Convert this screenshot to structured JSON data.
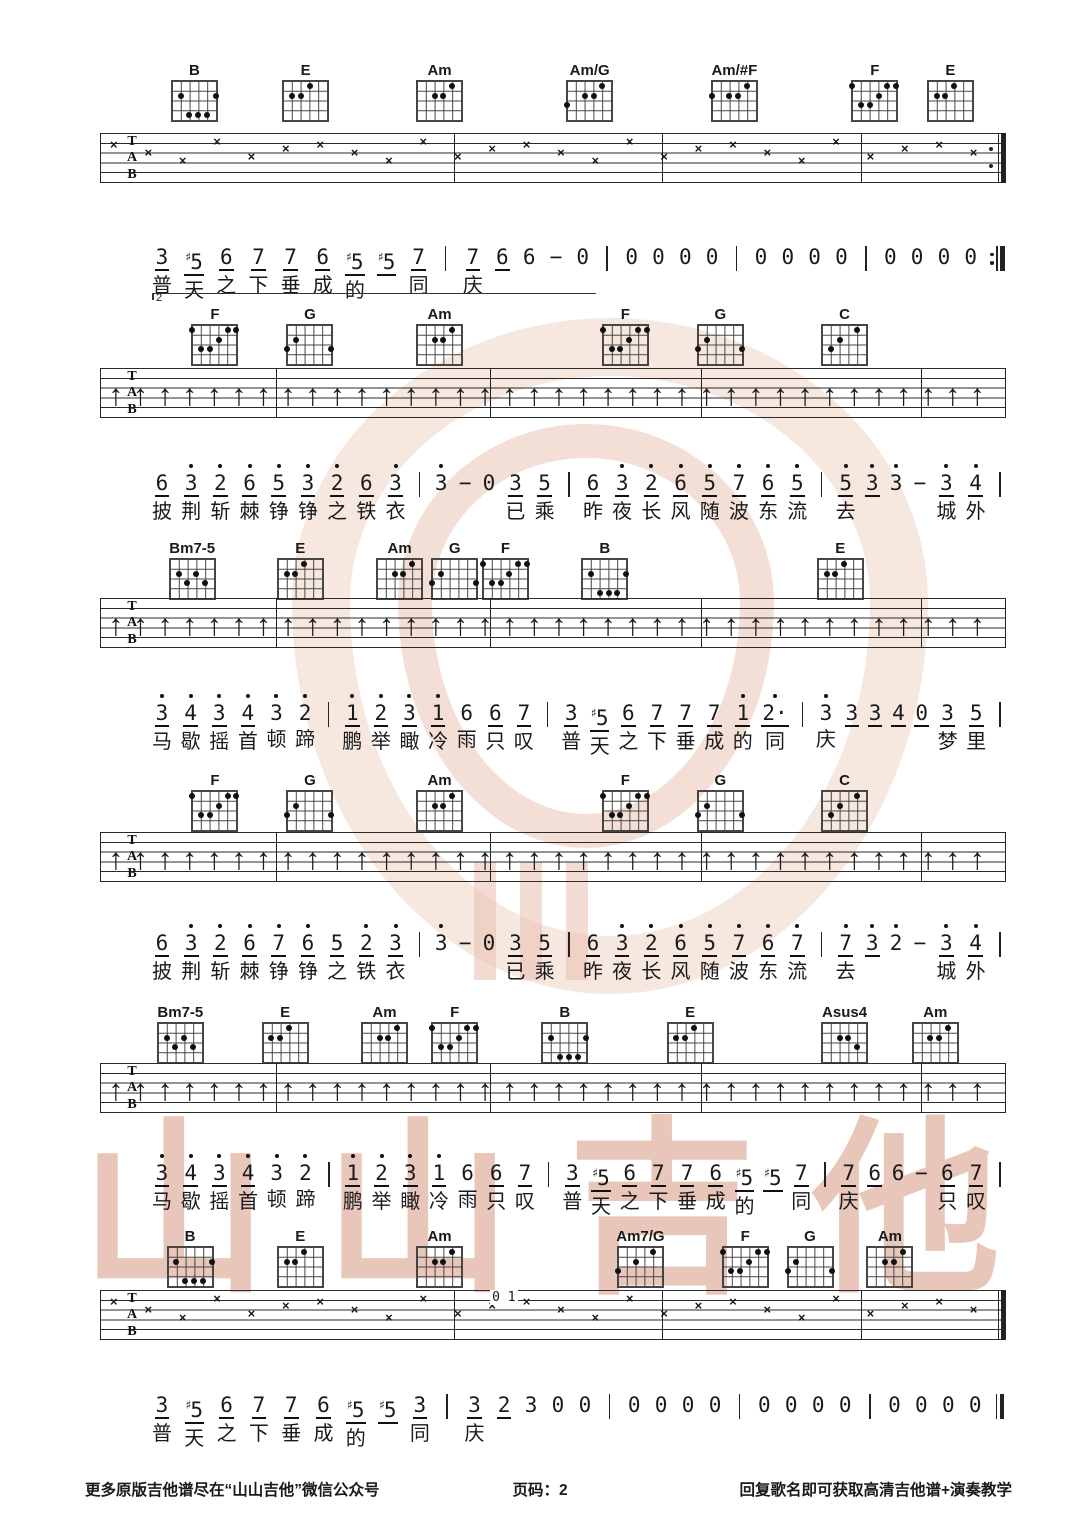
{
  "page_kind": "guitar-tab-sheet",
  "footer": {
    "left": "更多原版吉他谱尽在“山山吉他”微信公众号",
    "center": "页码：2",
    "right": "回复歌名即可获取高清吉他谱+演奏教学"
  },
  "watermark_brand_chars": [
    "山",
    "山",
    "吉",
    "他"
  ],
  "watermark_color": "#d18e76",
  "tab_labels": [
    "T",
    "A",
    "B"
  ],
  "chord_shapes": {
    "B": [
      [
        5,
        2
      ],
      [
        1,
        2
      ],
      [
        4,
        4
      ],
      [
        3,
        4
      ],
      [
        2,
        4
      ]
    ],
    "E": [
      [
        5,
        2
      ],
      [
        4,
        2
      ],
      [
        3,
        1
      ]
    ],
    "Am": [
      [
        4,
        2
      ],
      [
        3,
        2
      ],
      [
        2,
        1
      ]
    ],
    "Am/G": [
      [
        6,
        3
      ],
      [
        4,
        2
      ],
      [
        3,
        2
      ],
      [
        2,
        1
      ]
    ],
    "Am/#F": [
      [
        6,
        2
      ],
      [
        4,
        2
      ],
      [
        3,
        2
      ],
      [
        2,
        1
      ]
    ],
    "F": [
      [
        6,
        1
      ],
      [
        5,
        3
      ],
      [
        4,
        3
      ],
      [
        3,
        2
      ],
      [
        2,
        1
      ],
      [
        1,
        1
      ]
    ],
    "G": [
      [
        6,
        3
      ],
      [
        5,
        2
      ],
      [
        1,
        3
      ]
    ],
    "C": [
      [
        5,
        3
      ],
      [
        4,
        2
      ],
      [
        2,
        1
      ]
    ],
    "Bm7-5": [
      [
        5,
        2
      ],
      [
        4,
        3
      ],
      [
        3,
        2
      ],
      [
        2,
        3
      ]
    ],
    "Asus4": [
      [
        4,
        2
      ],
      [
        3,
        2
      ],
      [
        2,
        3
      ]
    ],
    "Am7/G": [
      [
        6,
        3
      ],
      [
        4,
        2
      ],
      [
        2,
        1
      ]
    ]
  },
  "systems": [
    {
      "chords": [
        {
          "name": "B",
          "x": 18.0
        },
        {
          "name": "E",
          "x": 28.3
        },
        {
          "name": "Am",
          "x": 40.7
        },
        {
          "name": "Am/G",
          "x": 54.6
        },
        {
          "name": "Am/#F",
          "x": 68.0
        },
        {
          "name": "F",
          "x": 81.0
        },
        {
          "name": "E",
          "x": 88.0
        }
      ],
      "tab_pattern": "x",
      "end": "repeat",
      "volta": "2",
      "notes": [
        "3_",
        "#5_",
        "6_",
        "7_",
        "7_",
        "6_",
        "#5_",
        "#5_",
        "7_",
        "|",
        "7_",
        "6_",
        "6",
        "−",
        "0",
        "|",
        "0",
        "0",
        "0",
        "0",
        "|",
        "0",
        "0",
        "0",
        "0",
        "|",
        "0",
        "0",
        "0",
        "0",
        ":||"
      ],
      "lyrics": {
        "0": "普",
        "1": "天",
        "2": "之",
        "3": "下",
        "4": "垂",
        "5": "成",
        "6": "的",
        "8": "同",
        "10": "庆"
      }
    },
    {
      "chords": [
        {
          "name": "F",
          "x": 19.9
        },
        {
          "name": "G",
          "x": 28.7
        },
        {
          "name": "Am",
          "x": 40.7
        },
        {
          "name": "F",
          "x": 57.9
        },
        {
          "name": "G",
          "x": 66.7
        },
        {
          "name": "C",
          "x": 78.2
        }
      ],
      "tab_pattern": "arrows",
      "end": "plain",
      "notes": [
        "6_",
        "3'_",
        "2'_",
        "6'_",
        "5'_",
        "3'_",
        "2'_",
        "6_",
        "3'_",
        "|",
        "3'",
        "−",
        "0",
        "3_",
        "5_",
        "|",
        "6_",
        "3'_",
        "2'_",
        "6'_",
        "5'_",
        "7'_",
        "6'_",
        "5'_",
        "|",
        "5'_",
        "3'_",
        "3'",
        "−",
        "3'_",
        "4'_",
        "|"
      ],
      "lyrics": {
        "0": "披",
        "1": "荆",
        "2": "斩",
        "3": "棘",
        "4": "铮",
        "5": "铮",
        "6": "之",
        "7": "铁",
        "8": "衣",
        "13": "已",
        "14": "乘",
        "16": "昨",
        "17": "夜",
        "18": "长",
        "19": "风",
        "20": "随",
        "21": "波",
        "22": "东",
        "23": "流",
        "25": "去",
        "29": "城",
        "30": "外"
      }
    },
    {
      "chords": [
        {
          "name": "Bm7-5",
          "x": 17.8
        },
        {
          "name": "E",
          "x": 27.8
        },
        {
          "name": "Am",
          "x": 37.0
        },
        {
          "name": "G",
          "x": 42.1
        },
        {
          "name": "F",
          "x": 46.8
        },
        {
          "name": "B",
          "x": 56.0
        },
        {
          "name": "E",
          "x": 77.8
        }
      ],
      "tab_pattern": "arrows",
      "end": "plain",
      "notes": [
        "3'_",
        "4'_",
        "3'_",
        "4'_",
        "3'",
        "2'",
        "|",
        "1'_",
        "2'_",
        "3'_",
        "1'_",
        "6",
        "6_",
        "7_",
        "|",
        "3_",
        "#5_",
        "6_",
        "7_",
        "7_",
        "7_",
        "1'_",
        "2'·_",
        "|",
        "3'",
        "3_",
        "3_",
        "4_",
        "0_",
        "3_",
        "5_",
        "|"
      ],
      "lyrics": {
        "0": "马",
        "1": "歇",
        "2": "摇",
        "3": "首",
        "4": "顿",
        "5": "蹄",
        "7": "鹏",
        "8": "举",
        "9": "瞰",
        "10": "冷",
        "11": "雨",
        "12": "只",
        "13": "叹",
        "15": "普",
        "16": "天",
        "17": "之",
        "18": "下",
        "19": "垂",
        "20": "成",
        "21": "的",
        "22": "同",
        "24": "庆",
        "29": "梦",
        "30": "里"
      }
    },
    {
      "chords": [
        {
          "name": "F",
          "x": 19.9
        },
        {
          "name": "G",
          "x": 28.7
        },
        {
          "name": "Am",
          "x": 40.7
        },
        {
          "name": "F",
          "x": 57.9
        },
        {
          "name": "G",
          "x": 66.7
        },
        {
          "name": "C",
          "x": 78.2
        }
      ],
      "tab_pattern": "arrows",
      "end": "plain",
      "notes": [
        "6_",
        "3'_",
        "2'_",
        "6'_",
        "7'_",
        "6'_",
        "5_",
        "2'_",
        "3'_",
        "|",
        "3'",
        "−",
        "0",
        "3_",
        "5_",
        "|",
        "6_",
        "3'_",
        "2'_",
        "6'_",
        "5'_",
        "7'_",
        "6'_",
        "7'_",
        "|",
        "7'_",
        "3'_",
        "2'",
        "−",
        "3'_",
        "4'_",
        "|"
      ],
      "lyrics": {
        "0": "披",
        "1": "荆",
        "2": "斩",
        "3": "棘",
        "4": "铮",
        "5": "铮",
        "6": "之",
        "7": "铁",
        "8": "衣",
        "13": "已",
        "14": "乘",
        "16": "昨",
        "17": "夜",
        "18": "长",
        "19": "风",
        "20": "随",
        "21": "波",
        "22": "东",
        "23": "流",
        "25": "去",
        "29": "城",
        "30": "外"
      }
    },
    {
      "chords": [
        {
          "name": "Bm7-5",
          "x": 16.7
        },
        {
          "name": "E",
          "x": 26.4
        },
        {
          "name": "Am",
          "x": 35.6
        },
        {
          "name": "F",
          "x": 42.1
        },
        {
          "name": "B",
          "x": 52.3
        },
        {
          "name": "E",
          "x": 63.9
        },
        {
          "name": "Asus4",
          "x": 78.2
        },
        {
          "name": "Am",
          "x": 86.6
        }
      ],
      "tab_pattern": "arrows",
      "end": "plain",
      "notes": [
        "3'_",
        "4'_",
        "3'_",
        "4'_",
        "3'",
        "2'",
        "|",
        "1'_",
        "2'_",
        "3'_",
        "1'_",
        "6",
        "6_",
        "7_",
        "|",
        "3_",
        "#5_",
        "6_",
        "7_",
        "7_",
        "6_",
        "#5_",
        "#5_",
        "7_",
        "|",
        "7_",
        "6_",
        "6",
        "−",
        "6_",
        "7_",
        "|"
      ],
      "lyrics": {
        "0": "马",
        "1": "歇",
        "2": "摇",
        "3": "首",
        "4": "顿",
        "5": "蹄",
        "7": "鹏",
        "8": "举",
        "9": "瞰",
        "10": "冷",
        "11": "雨",
        "12": "只",
        "13": "叹",
        "15": "普",
        "16": "天",
        "17": "之",
        "18": "下",
        "19": "垂",
        "20": "成",
        "21": "的",
        "23": "同",
        "25": "庆",
        "29": "只",
        "30": "叹"
      }
    },
    {
      "chords": [
        {
          "name": "B",
          "x": 17.6
        },
        {
          "name": "E",
          "x": 27.8
        },
        {
          "name": "Am",
          "x": 40.7
        },
        {
          "name": "Am7/G",
          "x": 59.3
        },
        {
          "name": "F",
          "x": 69.0
        },
        {
          "name": "G",
          "x": 75.0
        },
        {
          "name": "Am",
          "x": 82.4
        }
      ],
      "tab_pattern": "x",
      "end": "final",
      "tab_note": "0 1",
      "notes": [
        "3_",
        "#5_",
        "6_",
        "7_",
        "7_",
        "6_",
        "#5_",
        "#5_",
        "3_",
        "|",
        "3_",
        "2_",
        "3",
        "0",
        "0",
        "|",
        "0",
        "0",
        "0",
        "0",
        "|",
        "0",
        "0",
        "0",
        "0",
        "|",
        "0",
        "0",
        "0",
        "0",
        "||"
      ],
      "lyrics": {
        "0": "普",
        "1": "天",
        "2": "之",
        "3": "下",
        "4": "垂",
        "5": "成",
        "6": "的",
        "8": "同",
        "10": "庆"
      }
    }
  ]
}
